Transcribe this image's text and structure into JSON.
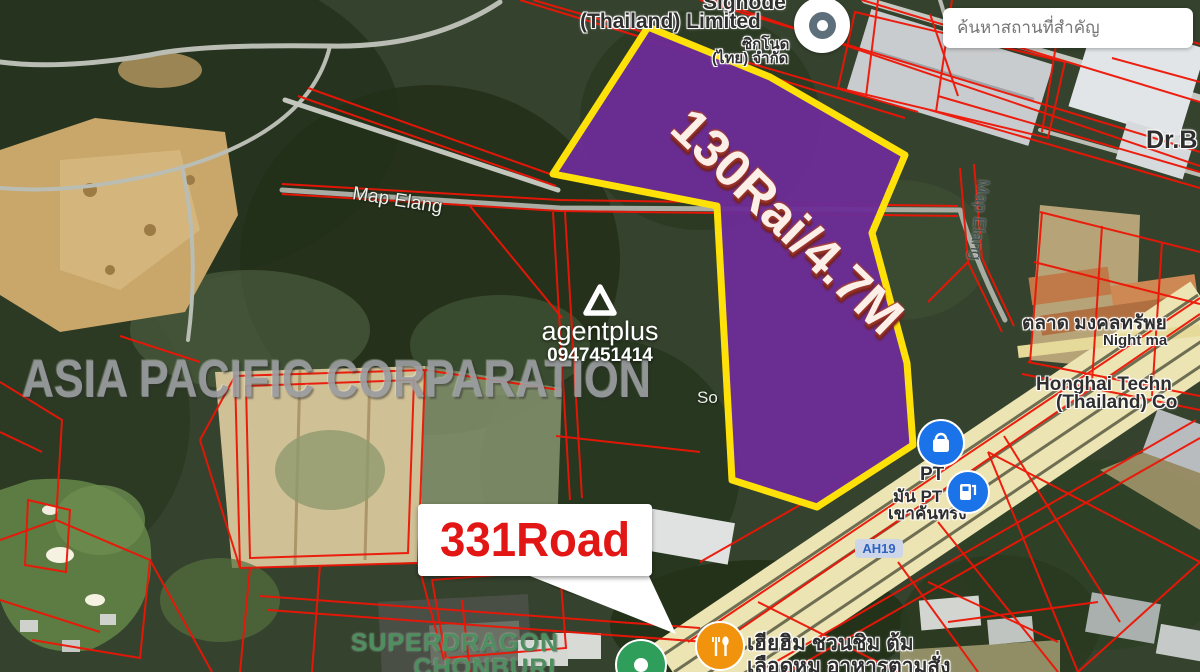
{
  "map": {
    "search": {
      "placeholder": "ค้นหาสถานที่สำคัญ"
    },
    "annotations": {
      "plot_label": "130Rai/4.7M",
      "road_callout": "331Road",
      "watermark": "ASIA PACIFIC CORPARATION",
      "agency_name": "agentplus",
      "agency_phone": "0947451414"
    },
    "labels": {
      "signode_line1": "Signode",
      "signode_line2": "(Thailand) Limited",
      "signode_thai1": "ซิกโนด",
      "signode_thai2": "(ไทย) จำกัด",
      "map_elang_road": "Map Elang",
      "map_elang_vertical": "Map Elang",
      "dr_b": "Dr.B",
      "market_thai": "ตลาด มงคลทรัพย",
      "night_market": "Night ma",
      "honghai_line1": "Honghai Techn",
      "honghai_line2": "(Thailand) Co",
      "pt_line1": "PT",
      "pt_line2": "มัน PT",
      "pt_line3": "เขาคันทรง",
      "ah19": "AH19",
      "soi_partial": "So",
      "superdragon_line1": "SUPERDRAGON",
      "superdragon_line2": "CHONBURI",
      "restaurant_line1": "เฮียฮิม ชวนชิม ต้ม",
      "restaurant_line2": "เลือดหมู อาหารตามสั่ง"
    },
    "icons": {
      "factory": "factory-marker",
      "shopping": "shopping-bag-marker",
      "fuel": "fuel-station-marker",
      "restaurant": "restaurant-marker",
      "golf": "golf-marker",
      "search": "search-input"
    },
    "colors": {
      "plot_fill": "#6C2D96",
      "plot_border": "#FFE10A",
      "parcel_line": "#ED1506",
      "highway_fill": "#EDE4B4",
      "callout_text": "#E31616",
      "marker_blue": "#1A73E8",
      "marker_orange": "#F2930D",
      "marker_green": "#2F9E5B"
    }
  }
}
